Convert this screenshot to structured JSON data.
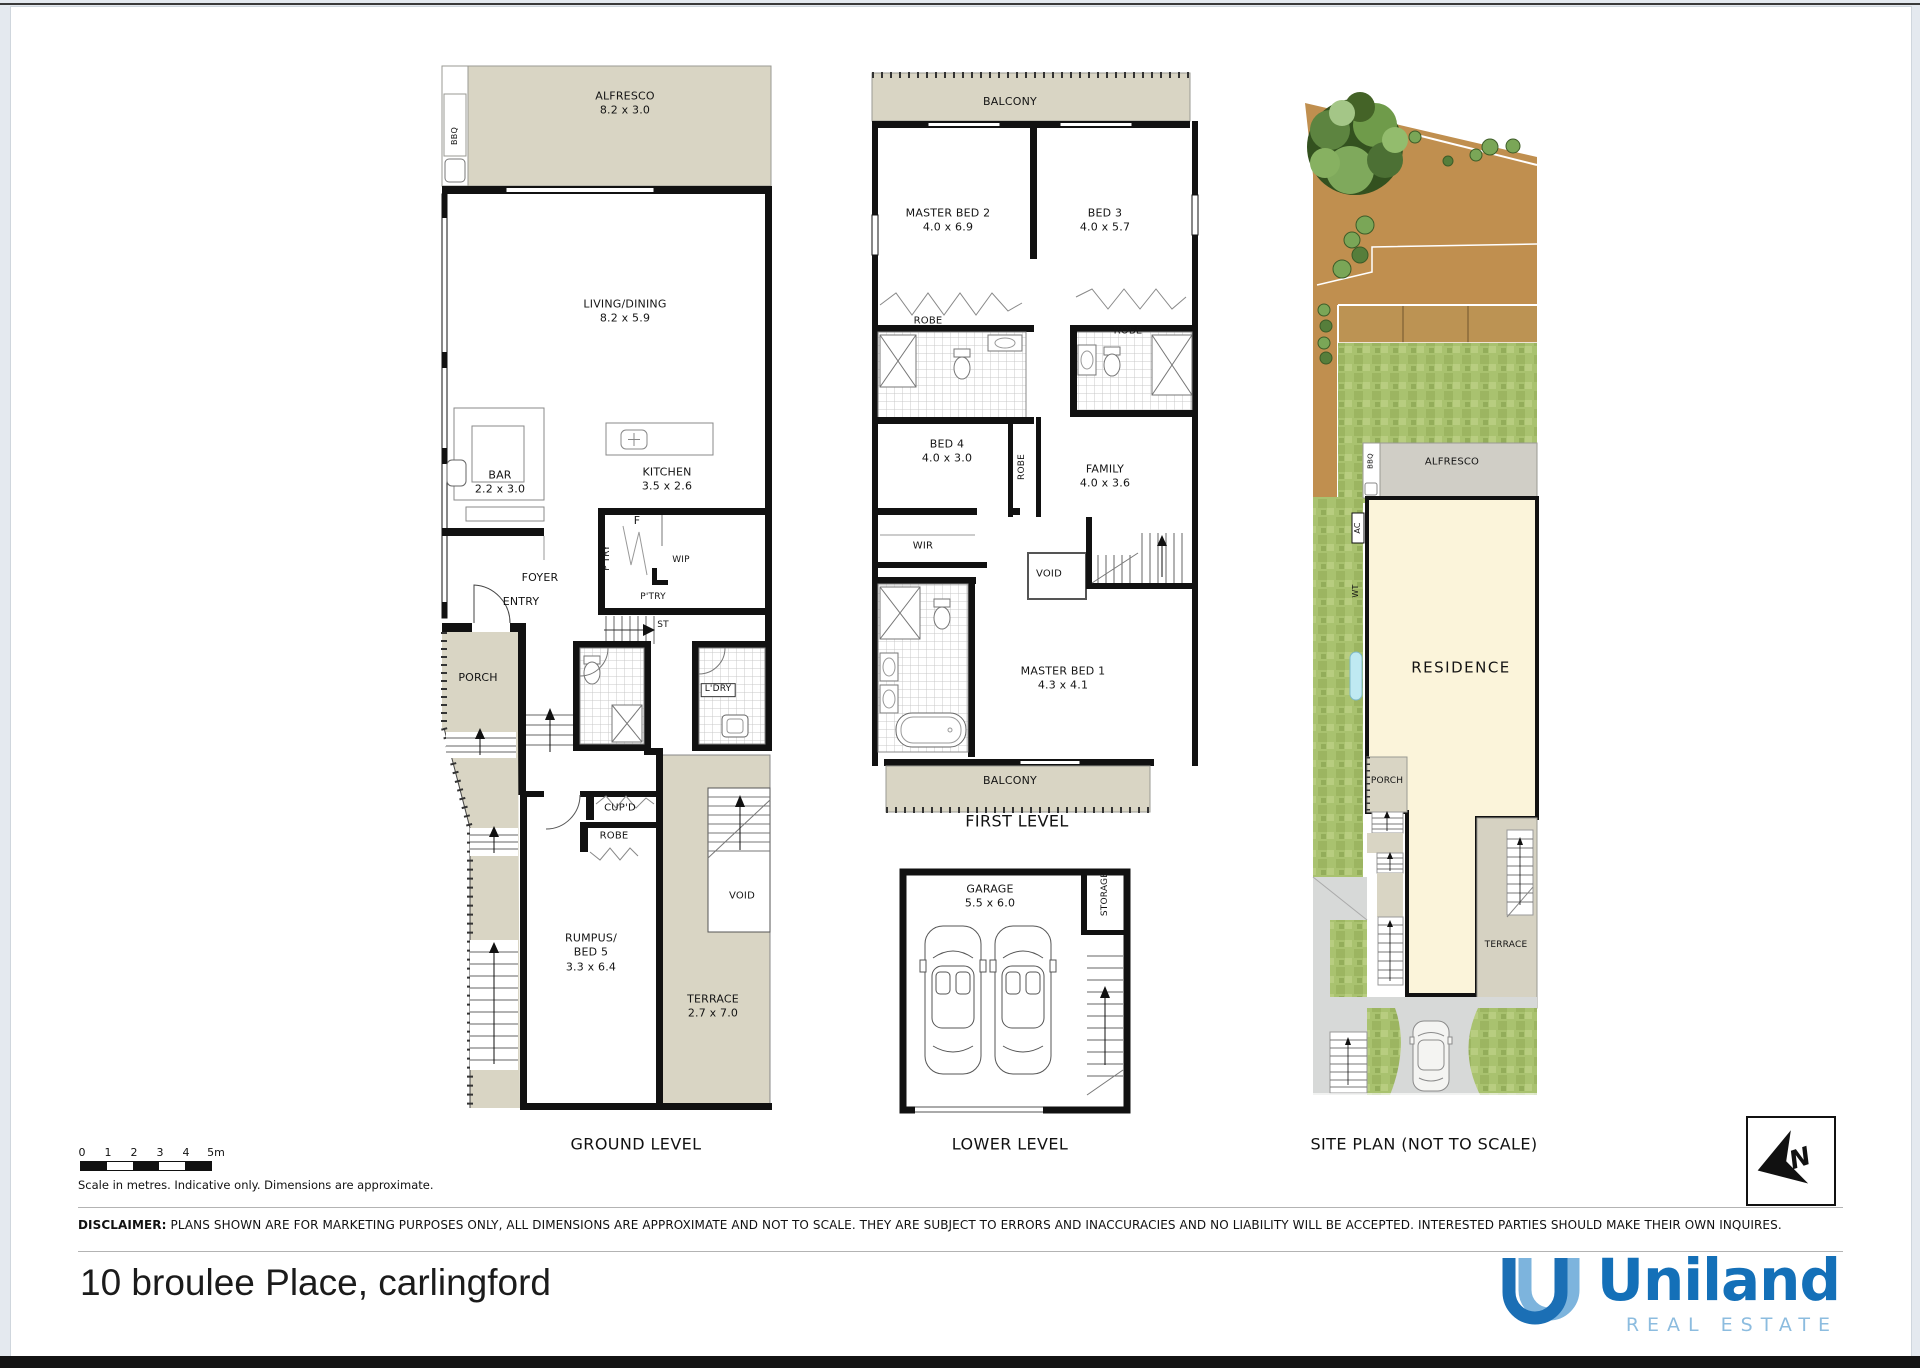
{
  "page": {
    "address": "10 broulee Place, carlingford",
    "disclaimer_bold": "DISCLAIMER:",
    "disclaimer_rest": " PLANS SHOWN ARE FOR MARKETING PURPOSES ONLY, ALL DIMENSIONS ARE APPROXIMATE AND NOT TO SCALE. THEY ARE SUBJECT TO ERRORS AND INACCURACIES AND NO LIABILITY WILL BE ACCEPTED. INTERESTED PARTIES SHOULD MAKE THEIR OWN INQUIRES.",
    "scale_note": "Scale in metres. Indicative only. Dimensions are approximate.",
    "scale_ticks": [
      "0",
      "1",
      "2",
      "3",
      "4",
      "5m"
    ]
  },
  "brand": {
    "name": "Uniland",
    "tagline": "REAL ESTATE",
    "brand_color": "#1470b8",
    "tagline_color": "#8cbcdf"
  },
  "compass": {
    "north_label": "N"
  },
  "titles": {
    "ground": "GROUND LEVEL",
    "first": "FIRST LEVEL",
    "lower": "LOWER LEVEL",
    "site": "SITE PLAN (NOT TO SCALE)"
  },
  "colors": {
    "outdoor_beige": "#d9d5c4",
    "site_dirt": "#c08f4f",
    "site_grass": "#a9c26f",
    "residence_cream": "#fbf4da",
    "water_tank": "#bfe9f2"
  },
  "ground": {
    "bbq": "BBQ",
    "alfresco": "ALFRESCO\n8.2 x 3.0",
    "living": "LIVING/DINING\n8.2 x 5.9",
    "bar": "BAR\n2.2 x 3.0",
    "kitchen": "KITCHEN\n3.5 x 2.6",
    "fridge": "F",
    "ptry_side": "P'TRY",
    "ptry": "P'TRY",
    "wip": "WIP",
    "st": "ST",
    "foyer": "FOYER",
    "entry": "ENTRY",
    "porch": "PORCH",
    "ldry": "L'DRY",
    "cupd": "CUP'D",
    "robe": "ROBE",
    "rumpus": "RUMPUS/\nBED 5\n3.3 x 6.4",
    "void": "VOID",
    "terrace": "TERRACE\n2.7 x 7.0"
  },
  "first": {
    "balcony_top": "BALCONY",
    "master2": "MASTER BED 2\n4.0 x 6.9",
    "bed3": "BED 3\n4.0 x 5.7",
    "robe_left": "ROBE",
    "robe_right": "ROBE",
    "bed4": "BED 4\n4.0 x 3.0",
    "robe_mid": "ROBE",
    "family": "FAMILY\n4.0 x 3.6",
    "wir": "WIR",
    "void": "VOID",
    "master1": "MASTER BED 1\n4.3 x 4.1",
    "balcony_bottom": "BALCONY"
  },
  "lower": {
    "garage": "GARAGE\n5.5 x 6.0",
    "storage": "STORAGE"
  },
  "site": {
    "alfresco": "ALFRESCO",
    "bbq": "BBQ",
    "ac": "AC",
    "wt": "WT",
    "residence": "RESIDENCE",
    "porch": "PORCH",
    "terrace": "TERRACE"
  }
}
